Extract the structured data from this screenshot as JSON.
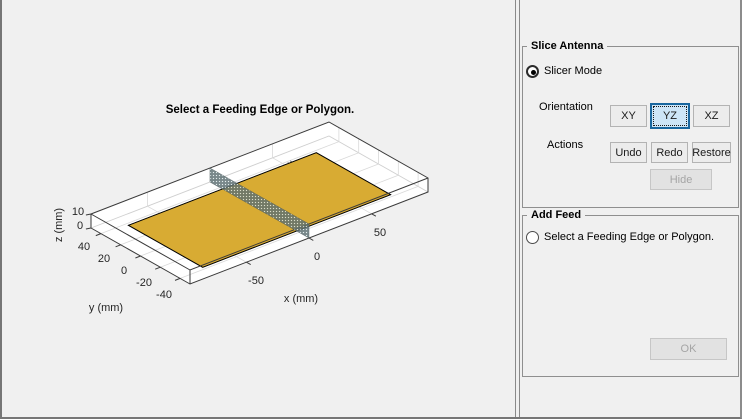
{
  "window": {
    "bg": "#f0f0f0"
  },
  "plot": {
    "title": "Select a Feeding Edge or Polygon.",
    "xlabel": "x (mm)",
    "ylabel": "y (mm)",
    "zlabel": "z (mm)",
    "x_tick_labels": [
      "-50",
      "0",
      "50"
    ],
    "y_tick_labels": [
      "40",
      "20",
      "0",
      "-20",
      "-40"
    ],
    "z_tick_labels": [
      "10",
      "0"
    ],
    "colors": {
      "plate_face": "#d8ab33",
      "mesh_edge": "#000000",
      "slice_base": "#5c6f72",
      "slice_dot": "#dce8ea",
      "box_edge": "#3a3a3a",
      "grid": "#d9d9d9",
      "inner_edge": "#cfcfcf",
      "box_face": "#ffffff"
    }
  },
  "panel": {
    "slice_antenna": {
      "title": "Slice Antenna",
      "slicer_mode_label": "Slicer Mode",
      "slicer_mode_selected": true,
      "orientation_label": "Orientation",
      "orientation_buttons": [
        {
          "label": "XY",
          "active": false
        },
        {
          "label": "YZ",
          "active": true
        },
        {
          "label": "XZ",
          "active": false
        }
      ],
      "actions_label": "Actions",
      "action_buttons": [
        "Undo",
        "Redo",
        "Restore"
      ],
      "hide_label": "Hide",
      "hide_enabled": false
    },
    "add_feed": {
      "title": "Add Feed",
      "radio_label": "Select a Feeding Edge or Polygon.",
      "radio_selected": false,
      "ok_label": "OK",
      "ok_enabled": false
    }
  },
  "chart_data": {
    "type": "mesh3d",
    "title": "Select a Feeding Edge or Polygon.",
    "xlabel": "x (mm)",
    "ylabel": "y (mm)",
    "zlabel": "z (mm)",
    "x_ticks": [
      -50,
      0,
      50
    ],
    "y_ticks": [
      40,
      20,
      0,
      -20,
      -40
    ],
    "z_ticks": [
      10,
      0
    ],
    "axes_box": {
      "x_range": [
        -95,
        95
      ],
      "y_range": [
        -50,
        50
      ],
      "z_range": [
        0,
        10
      ]
    },
    "view": "3-D oblique, orthographic",
    "grid": true,
    "objects": [
      {
        "name": "patch-antenna-mesh",
        "type": "triangulated-surface",
        "x_extent": [
          -75,
          75
        ],
        "y_extent": [
          -37.5,
          37.5
        ],
        "z": 0,
        "face_color": "#d8ab33",
        "edge_color": "#000000",
        "dense_refinement_regions": 2
      },
      {
        "name": "slice-plane",
        "type": "plane",
        "orientation": "YZ",
        "x_position": 0,
        "z_extent": [
          0,
          10
        ],
        "style": "stippled translucent",
        "color": "#5c6f72"
      }
    ]
  }
}
